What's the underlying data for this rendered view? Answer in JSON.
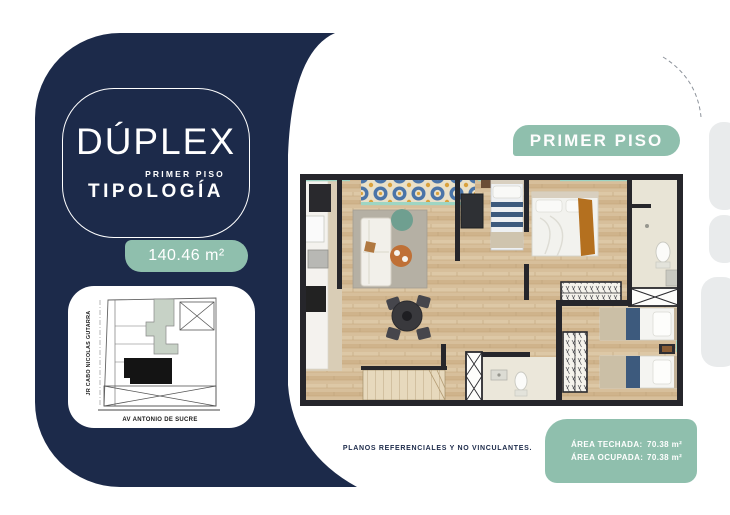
{
  "colors": {
    "navy": "#1c2a4a",
    "teal": "#8fbfad",
    "mint_window": "#9ed5c3",
    "wood_floor": "#d7bf9b",
    "wall": "#26262b",
    "site_building_fill": "#141414",
    "site_building_sage": "#c7d2c6",
    "edge_tab_gray": "#e9ebec"
  },
  "left_panel": {
    "title": "DÚPLEX",
    "subtitle_top": "PRIMER PISO",
    "subtitle": "TIPOLOGÍA",
    "area_badge": "140.46 m²",
    "site_map": {
      "street_vertical": "JR CABO NICOLAS GUTARRA",
      "street_horizontal": "AV ANTONIO DE SUCRE"
    }
  },
  "plan": {
    "floor_badge": "PRIMER PISO",
    "disclaimer": "PLANOS REFERENCIALES Y NO VINCULANTES.",
    "area_info": {
      "techada_label": "ÁREA TECHADA:",
      "techada_value": "70.38 m²",
      "ocupada_label": "ÁREA OCUPADA:",
      "ocupada_value": "70.38 m²"
    }
  }
}
